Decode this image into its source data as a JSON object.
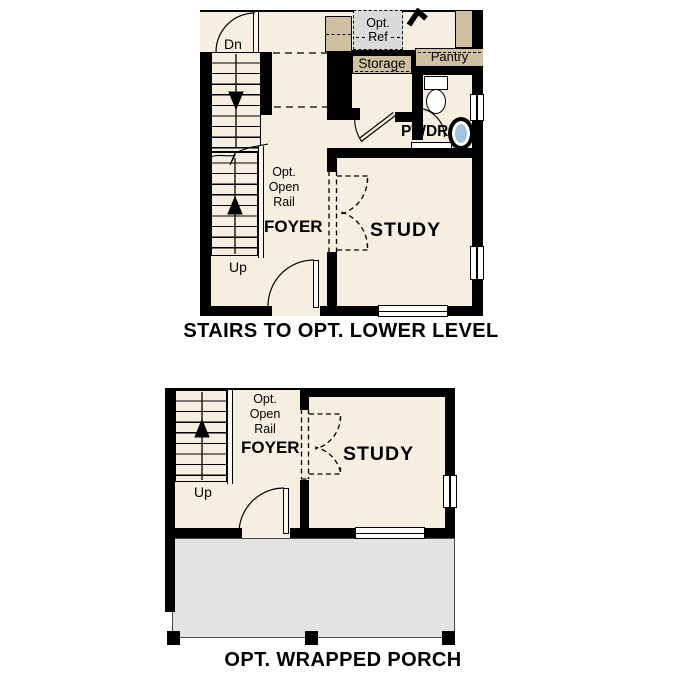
{
  "colors": {
    "wall": "#000000",
    "room_cream": "#f6eee1",
    "cabinet_tan": "#cfc0a2",
    "ref_gray": "#dadada",
    "porch_gray": "#e3e3e3",
    "sink_blue": "#9fc4e2",
    "text": "#000000"
  },
  "captions": {
    "upper": "STAIRS TO OPT. LOWER LEVEL",
    "lower": "OPT. WRAPPED PORCH"
  },
  "upper_plan": {
    "stair_down_label": "Dn",
    "stair_up_label": "Up",
    "opt_ref": {
      "line1": "Opt.",
      "line2": "Ref"
    },
    "storage_label": "Storage",
    "pantry_label": "Pantry",
    "powder_label": "PWDR",
    "open_rail": {
      "line1": "Opt.",
      "line2": "Open",
      "line3": "Rail"
    },
    "foyer_label": "FOYER",
    "study_label": "STUDY"
  },
  "lower_plan": {
    "stair_up_label": "Up",
    "open_rail": {
      "line1": "Opt.",
      "line2": "Open",
      "line3": "Rail"
    },
    "foyer_label": "FOYER",
    "study_label": "STUDY"
  }
}
